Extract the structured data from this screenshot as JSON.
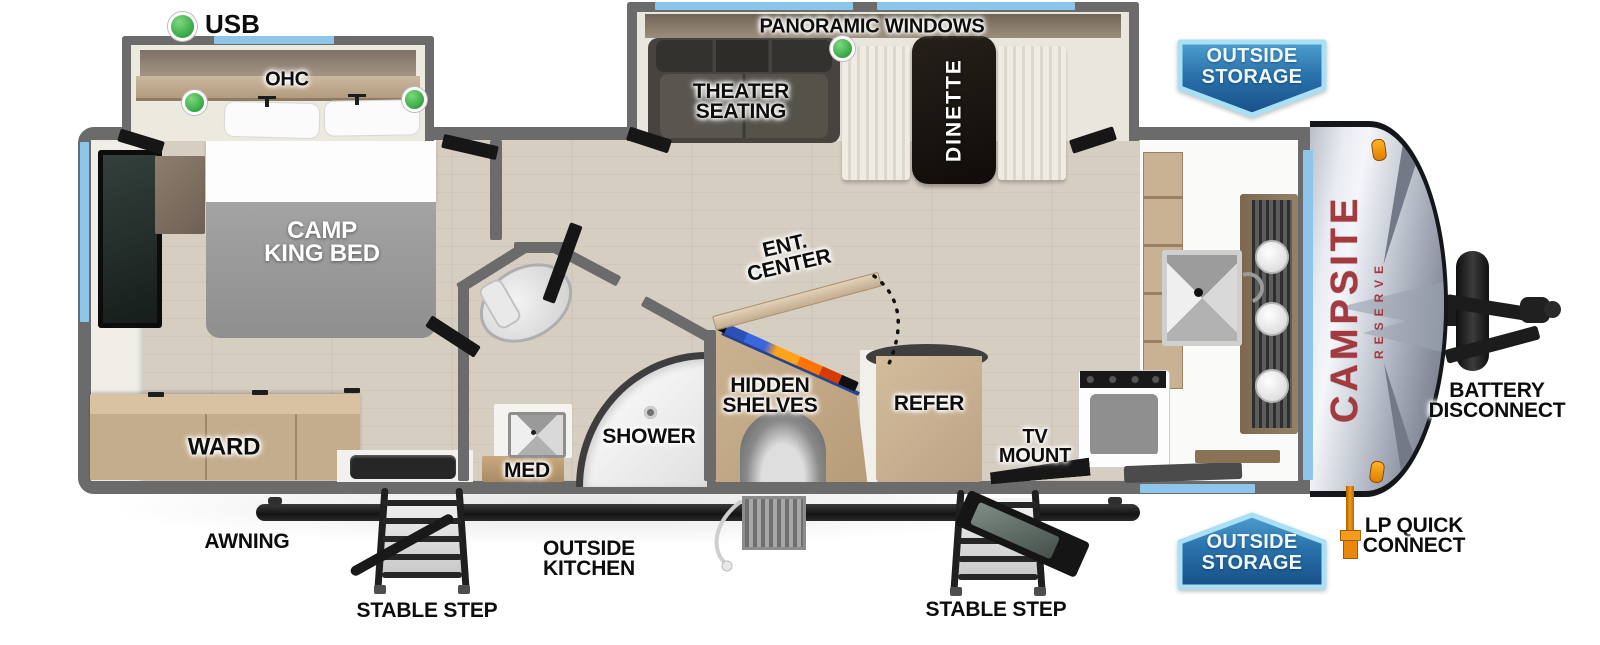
{
  "legend": {
    "usb_label": "USB"
  },
  "labels": {
    "ohc": "OHC",
    "camp_king_bed": "CAMP\nKING BED",
    "ward": "WARD",
    "panoramic_windows": "PANORAMIC WINDOWS",
    "theater_seating": "THEATER\nSEATING",
    "dinette": "DINETTE",
    "shower": "SHOWER",
    "med": "MED",
    "ent_center": "ENT.\nCENTER",
    "hidden_shelves": "HIDDEN\nSHELVES",
    "refer": "REFER",
    "tv_mount": "TV\nMOUNT",
    "awning": "AWNING",
    "outside_kitchen": "OUTSIDE\nKITCHEN",
    "stable_step_left": "STABLE STEP",
    "stable_step_right": "STABLE STEP",
    "outside_storage_top": "OUTSIDE\nSTORAGE",
    "outside_storage_bottom": "OUTSIDE\nSTORAGE",
    "battery_disconnect": "BATTERY\nDISCONNECT",
    "lp_quick_connect": "LP QUICK\nCONNECT"
  },
  "brand": {
    "name": "CAMPSITE",
    "series": "RESERVE"
  },
  "colors": {
    "usb_green": "#3fae49",
    "window_blue": "#8dc6ea",
    "banner_blue_dark": "#174f86",
    "banner_border": "#a9e0f5",
    "wall_gray": "#6b6b6b",
    "logo_red": "#a23a40",
    "lp_orange": "#f59a1c"
  }
}
